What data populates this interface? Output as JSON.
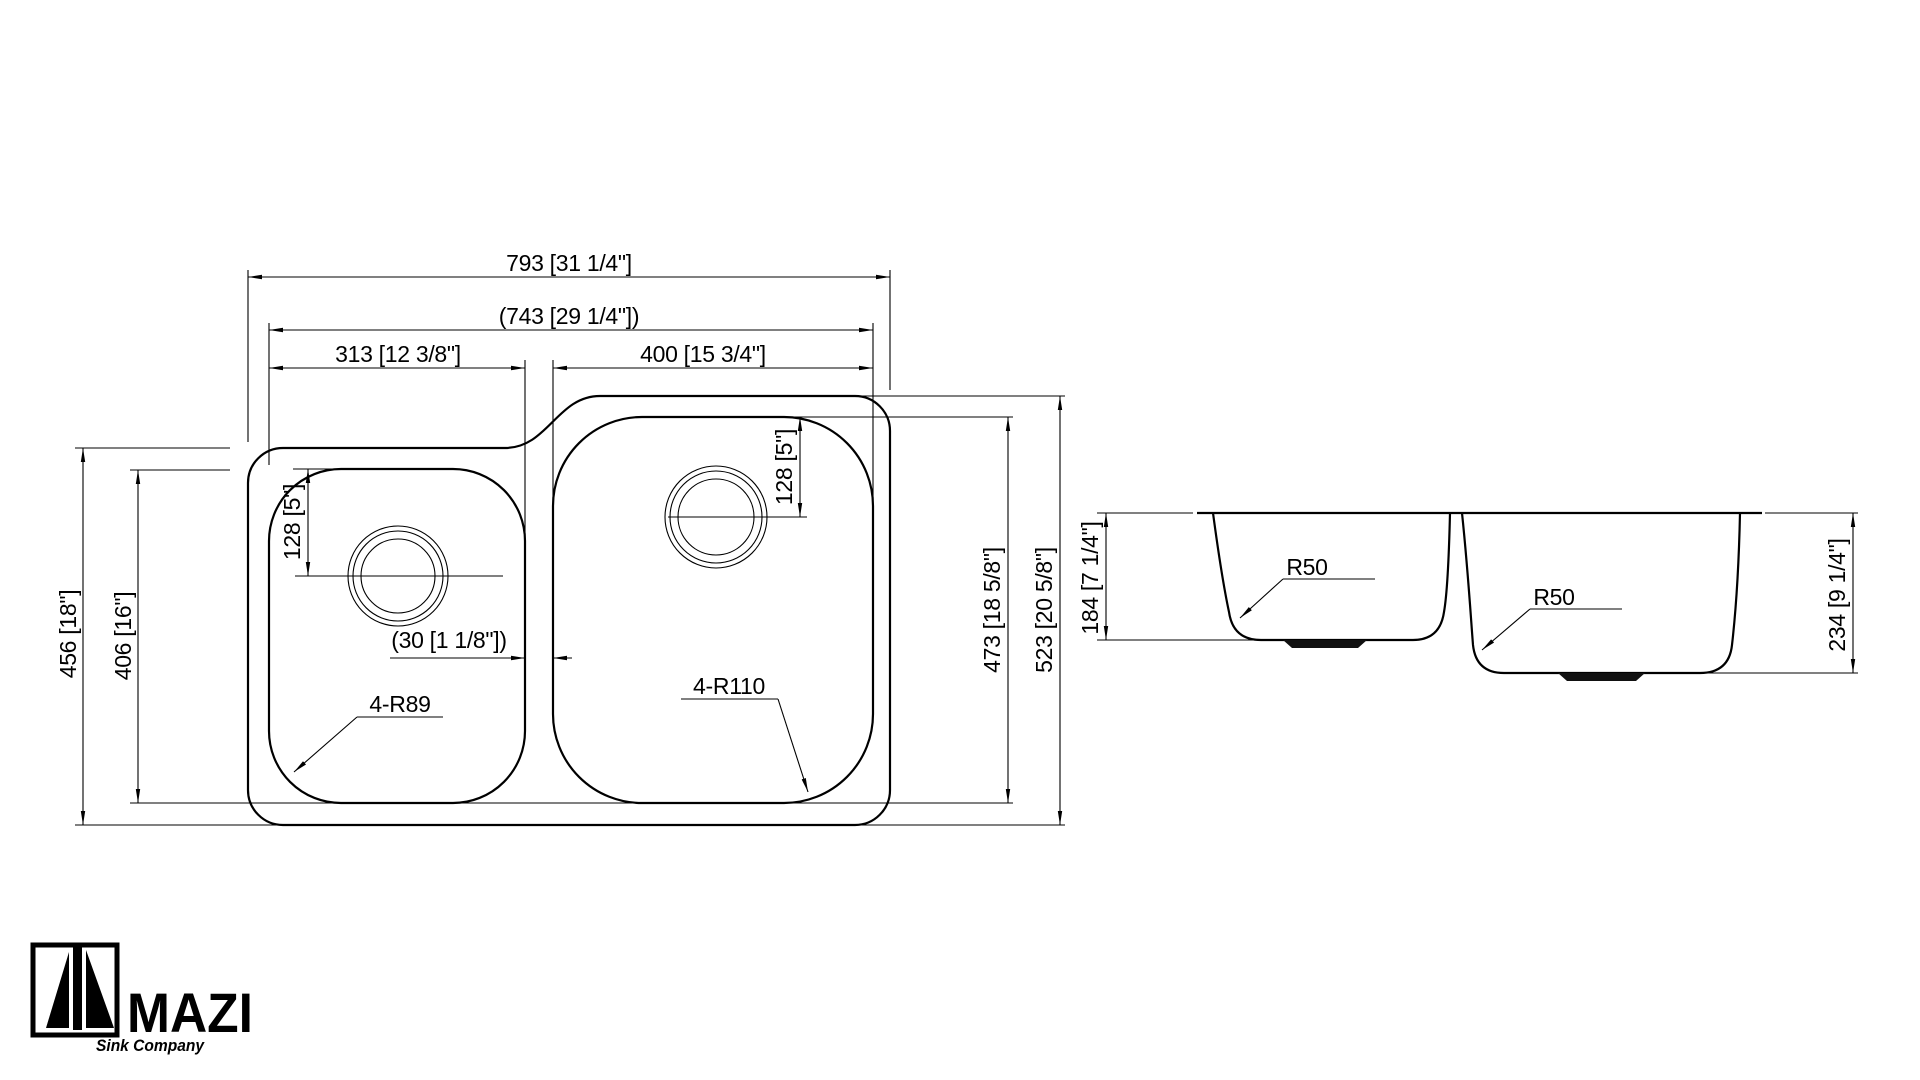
{
  "drawing": {
    "background": "#ffffff",
    "line_color": "#000000",
    "front_view": {
      "dims": {
        "overall_width": "793 [31 1/4\"]",
        "inner_width": "(743 [29 1/4\"])",
        "small_bowl_width": "313 [12 3/8\"]",
        "large_bowl_width": "400 [15 3/4\"]",
        "overall_depth": "456 [18\"]",
        "small_bowl_depth": "406 [16\"]",
        "small_drain_offset": "128 [5\"]",
        "large_drain_offset": "128 [5\"]",
        "divider_width": "(30 [1 1/8\"])",
        "small_bowl_corner_radius": "4-R89",
        "large_bowl_corner_radius": "4-R110",
        "large_bowl_height": "473 [18 5/8\"]",
        "overall_height": "523 [20 5/8\"]"
      }
    },
    "side_view": {
      "dims": {
        "small_bowl_depth": "184 [7 1/4\"]",
        "large_bowl_depth": "234 [9 1/4\"]",
        "small_bowl_bottom_radius": "R50",
        "large_bowl_bottom_radius": "R50"
      }
    },
    "logo": {
      "name": "MAZI",
      "tagline": "Sink Company"
    }
  }
}
